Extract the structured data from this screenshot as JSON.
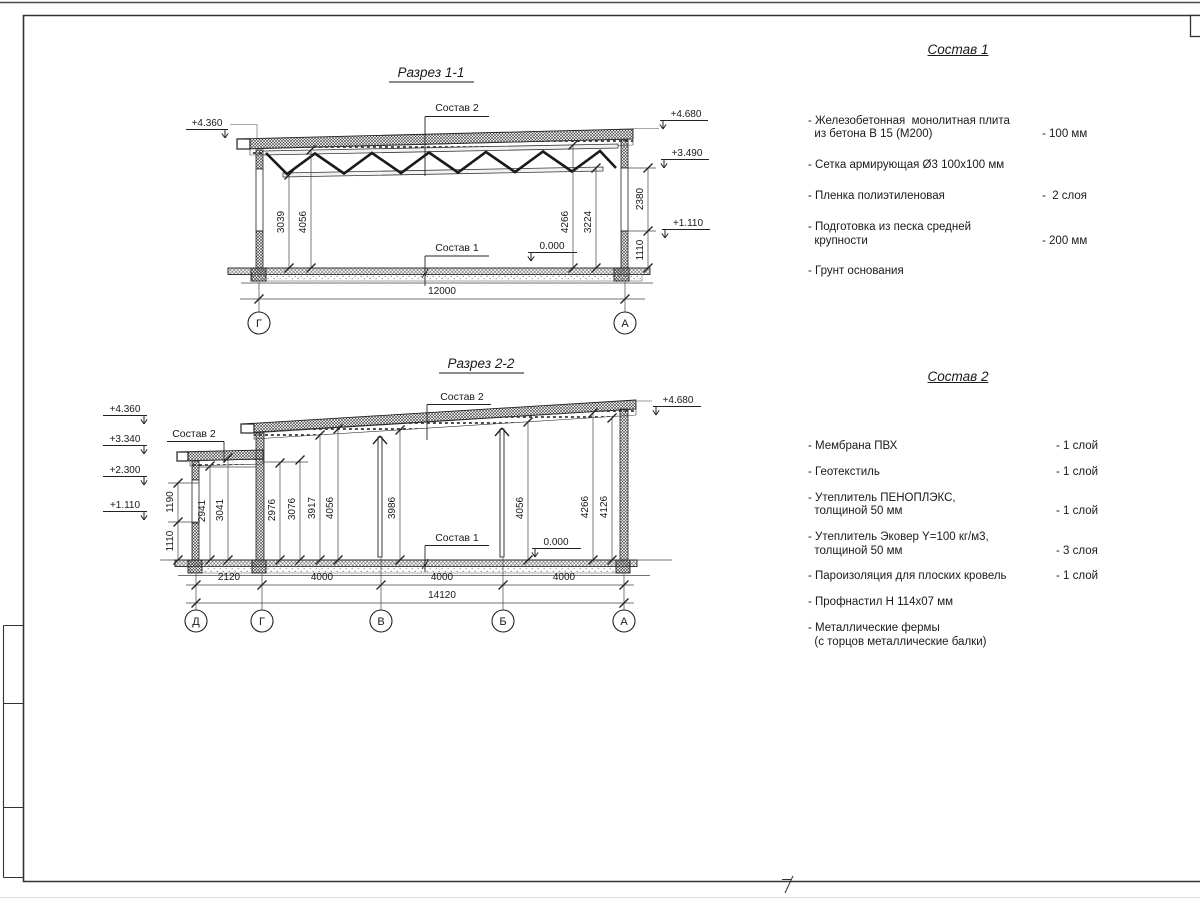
{
  "section1": {
    "title": "Разрез 1-1",
    "sostav2_label": "Состав 2",
    "sostav1_label": "Состав 1",
    "zero_mark": "0.000",
    "elev_left": "+4.360",
    "elev_right_top": "+4.680",
    "elev_right_mid": "+3.490",
    "elev_right_low": "+1.110",
    "dim_v1": "3039",
    "dim_v2": "4056",
    "dim_v3": "4266",
    "dim_v4": "3224",
    "dim_r1": "2380",
    "dim_r2": "1110",
    "dim_span": "12000",
    "axes": [
      "Г",
      "А"
    ]
  },
  "section2": {
    "title": "Разрез 2-2",
    "sostav2_small_label": "Состав 2",
    "sostav2_main_label": "Состав 2",
    "sostav1_label": "Состав 1",
    "zero_mark": "0.000",
    "elev_l1": "+4.360",
    "elev_l2": "+3.340",
    "elev_l3": "+2.300",
    "elev_l4": "+1.110",
    "elev_right": "+4.680",
    "dim_wall_upper": "1190",
    "dim_wall_lower": "1110",
    "dims_vertical": [
      "2941",
      "3041",
      "2976",
      "3076",
      "3917",
      "4056",
      "3986",
      "4056",
      "4266",
      "4126"
    ],
    "dims_bottom": [
      "2120",
      "4000",
      "4000",
      "4000"
    ],
    "dim_total": "14120",
    "axes": [
      "Д",
      "Г",
      "В",
      "Б",
      "А"
    ]
  },
  "sostav1": {
    "title": "Состав 1",
    "items": [
      {
        "name": "- Железобетонная  монолитная плита\n  из бетона В 15 (М200)",
        "value": "- 100 мм"
      },
      {
        "name": "- Сетка армирующая Ø3 100х100 мм",
        "value": ""
      },
      {
        "name": "- Пленка полиэтиленовая",
        "value": "-  2 слоя"
      },
      {
        "name": "- Подготовка из песка средней\n  крупности",
        "value": "- 200 мм"
      },
      {
        "name": "- Грунт основания",
        "value": ""
      }
    ]
  },
  "sostav2": {
    "title": "Состав 2",
    "items": [
      {
        "name": "- Мембрана ПВХ",
        "value": "- 1 слой"
      },
      {
        "name": "- Геотекстиль",
        "value": "- 1 слой"
      },
      {
        "name": "- Утеплитель ПЕНОПЛЭКС,\n  толщиной 50 мм",
        "value": "- 1 слой"
      },
      {
        "name": "- Утеплитель Эковер Y=100 кг/м3,\n  толщиной 50 мм",
        "value": "- 3 слоя"
      },
      {
        "name": "- Пароизоляция для плоских кровель",
        "value": "- 1 слой"
      },
      {
        "name": "- Профнастил Н 114х07 мм",
        "value": ""
      },
      {
        "name": "- Металлические фермы\n  (с торцов металлические балки)",
        "value": ""
      }
    ]
  }
}
